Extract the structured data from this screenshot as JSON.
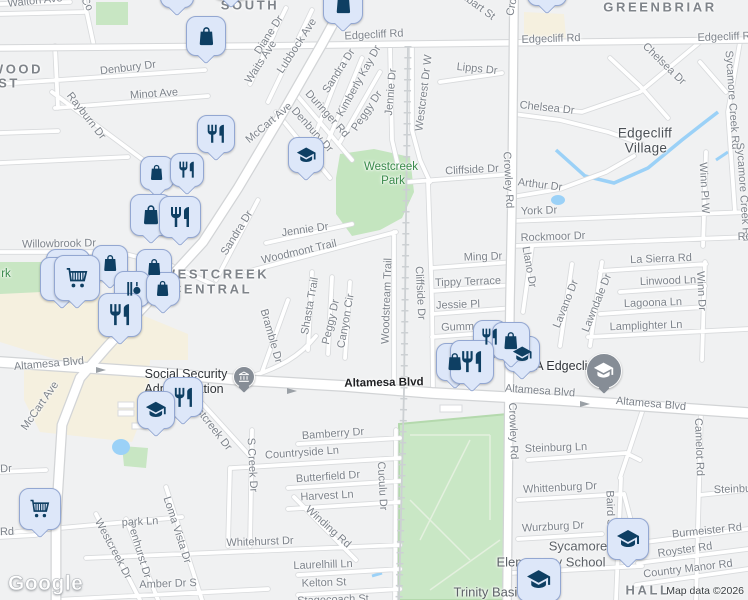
{
  "attribution": {
    "logo": "Google",
    "map_data": "Map data ©2026"
  },
  "colors": {
    "land": "#f0f1f2",
    "road_fill": "#ffffff",
    "road_casing": "#d8dadc",
    "park_green": "#c8e6c3",
    "water_blue": "#9bd1f7",
    "commercial_beige": "#f5f0df",
    "marker_bg": "#dde7f9",
    "marker_border": "#93a7d2",
    "marker_icon": "#0e3f63",
    "poi_circle_gray": "#868d96"
  },
  "labels": [
    {
      "t": "SOUTH",
      "x": 250,
      "y": 5,
      "r": 0,
      "c": "district"
    },
    {
      "t": "GREENBRIAR",
      "x": 660,
      "y": 7,
      "r": 0,
      "c": "district"
    },
    {
      "t": "WOOD",
      "x": 17,
      "y": 69,
      "r": 0,
      "c": "district"
    },
    {
      "t": "ST",
      "x": 9,
      "y": 83,
      "r": 0,
      "c": "district"
    },
    {
      "t": "WESTCREEK",
      "x": 216,
      "y": 274,
      "r": 0,
      "c": "district"
    },
    {
      "t": "CENTRAL",
      "x": 212,
      "y": 289,
      "r": 0,
      "c": "district"
    },
    {
      "t": "HALL",
      "x": 648,
      "y": 590,
      "r": 0,
      "c": "district"
    },
    {
      "t": "Edgecliff",
      "x": 645,
      "y": 133,
      "r": 0,
      "c": "city"
    },
    {
      "t": "Village",
      "x": 646,
      "y": 148,
      "r": 0,
      "c": "city"
    },
    {
      "t": "Westcreek",
      "x": 391,
      "y": 167,
      "r": 0,
      "c": "park"
    },
    {
      "t": "Park",
      "x": 393,
      "y": 181,
      "r": 0,
      "c": "park"
    },
    {
      "t": "rk",
      "x": 6,
      "y": 274,
      "r": 0,
      "c": "park"
    },
    {
      "t": "Social Security",
      "x": 186,
      "y": 374,
      "r": 0,
      "c": "poi"
    },
    {
      "t": "Administration",
      "x": 184,
      "y": 389,
      "r": 0,
      "c": "poi"
    },
    {
      "t": "DEA Edgecliff",
      "x": 556,
      "y": 366,
      "r": 0,
      "c": "poi"
    },
    {
      "t": "Sycamore",
      "x": 578,
      "y": 546,
      "r": 0,
      "c": "school"
    },
    {
      "t": "Elementary School",
      "x": 551,
      "y": 562,
      "r": 0,
      "c": "school"
    },
    {
      "t": "Trinity Basin",
      "x": 489,
      "y": 592,
      "r": 0,
      "c": "school"
    },
    {
      "t": "Altamesa Blvd",
      "x": 384,
      "y": 383,
      "r": -1,
      "c": "road-dark"
    },
    {
      "t": "Walton Ave",
      "x": 35,
      "y": 1,
      "r": -6,
      "c": "road"
    },
    {
      "t": "Co",
      "x": 87,
      "y": 4,
      "r": 62,
      "c": "road"
    },
    {
      "t": "Denbury Dr",
      "x": 128,
      "y": 68,
      "r": -7,
      "c": "road"
    },
    {
      "t": "Minot Ave",
      "x": 154,
      "y": 94,
      "r": -4,
      "c": "road"
    },
    {
      "t": "Rayburn Dr",
      "x": 86,
      "y": 116,
      "r": 52,
      "c": "road"
    },
    {
      "t": "Diane Dr",
      "x": 269,
      "y": 35,
      "r": -57,
      "c": "road"
    },
    {
      "t": "Waits Ave",
      "x": 261,
      "y": 62,
      "r": -57,
      "c": "road"
    },
    {
      "t": "Lubbock Ave",
      "x": 297,
      "y": 46,
      "r": -57,
      "c": "road"
    },
    {
      "t": "Edgecliff Rd",
      "x": 374,
      "y": 35,
      "r": -3,
      "c": "road"
    },
    {
      "t": "Edgecliff Rd",
      "x": 551,
      "y": 39,
      "r": -2,
      "c": "road"
    },
    {
      "t": "Edgecliff Rd",
      "x": 727,
      "y": 37,
      "r": -2,
      "c": "road"
    },
    {
      "t": "Lambart St",
      "x": 472,
      "y": 2,
      "r": 36,
      "c": "road"
    },
    {
      "t": "Chelsea Dr",
      "x": 664,
      "y": 64,
      "r": 44,
      "c": "road"
    },
    {
      "t": "Chelsea Dr",
      "x": 547,
      "y": 108,
      "r": 6,
      "c": "road"
    },
    {
      "t": "Lipps Dr",
      "x": 477,
      "y": 69,
      "r": 6,
      "c": "road"
    },
    {
      "t": "Sandra Dr",
      "x": 339,
      "y": 71,
      "r": -57,
      "c": "road"
    },
    {
      "t": "Kimberly Kay Dr",
      "x": 359,
      "y": 81,
      "r": -61,
      "c": "road"
    },
    {
      "t": "Peggy Dr",
      "x": 367,
      "y": 111,
      "r": -56,
      "c": "road"
    },
    {
      "t": "Jennie Dr",
      "x": 391,
      "y": 92,
      "r": -85,
      "c": "road"
    },
    {
      "t": "Duringer Rd",
      "x": 327,
      "y": 114,
      "r": 48,
      "c": "road"
    },
    {
      "t": "Denbury Dr",
      "x": 312,
      "y": 130,
      "r": 48,
      "c": "road"
    },
    {
      "t": "McCart Ave",
      "x": 269,
      "y": 123,
      "r": -40,
      "c": "road"
    },
    {
      "t": "Westcrest Dr W",
      "x": 424,
      "y": 93,
      "r": -83,
      "c": "road"
    },
    {
      "t": "Sycamore Creek Rd",
      "x": 732,
      "y": 100,
      "r": 86,
      "c": "road"
    },
    {
      "t": "Sycamore Creek Rd",
      "x": 743,
      "y": 192,
      "r": 86,
      "c": "road"
    },
    {
      "t": "Crowley Rd",
      "x": 516,
      "y": -12,
      "r": -78,
      "c": "road"
    },
    {
      "t": "Crowley Rd",
      "x": 508,
      "y": 180,
      "r": 87,
      "c": "road"
    },
    {
      "t": "Crowley Rd",
      "x": 513,
      "y": 431,
      "r": 88,
      "c": "road"
    },
    {
      "t": "Arthur Dr",
      "x": 540,
      "y": 185,
      "r": 7,
      "c": "road"
    },
    {
      "t": "York Dr",
      "x": 539,
      "y": 211,
      "r": -2,
      "c": "road"
    },
    {
      "t": "Rockmoor Dr",
      "x": 553,
      "y": 237,
      "r": -2,
      "c": "road"
    },
    {
      "t": "Rockmoor Dr",
      "x": 770,
      "y": 236,
      "r": -2,
      "c": "road"
    },
    {
      "t": "Llano Dr",
      "x": 529,
      "y": 267,
      "r": 80,
      "c": "road"
    },
    {
      "t": "La Sierra Rd",
      "x": 661,
      "y": 259,
      "r": -2,
      "c": "road"
    },
    {
      "t": "Linwood Ln",
      "x": 668,
      "y": 281,
      "r": -2,
      "c": "road"
    },
    {
      "t": "Lagoona Ln",
      "x": 653,
      "y": 303,
      "r": -2,
      "c": "road"
    },
    {
      "t": "Lamplighter Ln",
      "x": 646,
      "y": 326,
      "r": -2,
      "c": "road"
    },
    {
      "t": "Winn Pl W",
      "x": 704,
      "y": 188,
      "r": 87,
      "c": "road"
    },
    {
      "t": "Winn Dr",
      "x": 701,
      "y": 291,
      "r": 87,
      "c": "road"
    },
    {
      "t": "Lavano Dr",
      "x": 566,
      "y": 304,
      "r": -68,
      "c": "road"
    },
    {
      "t": "Lawndale Dr",
      "x": 597,
      "y": 303,
      "r": -68,
      "c": "road"
    },
    {
      "t": "Ming Dr",
      "x": 483,
      "y": 257,
      "r": -2,
      "c": "road"
    },
    {
      "t": "Tippy Terrace",
      "x": 468,
      "y": 282,
      "r": -2,
      "c": "road"
    },
    {
      "t": "Jessie Pl",
      "x": 458,
      "y": 305,
      "r": -2,
      "c": "road"
    },
    {
      "t": "Gumm Pl",
      "x": 464,
      "y": 327,
      "r": -2,
      "c": "road"
    },
    {
      "t": "Cliffside Dr",
      "x": 472,
      "y": 170,
      "r": -3,
      "c": "road"
    },
    {
      "t": "Cliffside Dr",
      "x": 420,
      "y": 293,
      "r": 87,
      "c": "road"
    },
    {
      "t": "Woodstream Trail",
      "x": 387,
      "y": 301,
      "r": -88,
      "c": "road"
    },
    {
      "t": "Canyon Cir",
      "x": 346,
      "y": 321,
      "r": -80,
      "c": "road"
    },
    {
      "t": "Peggy Dr",
      "x": 331,
      "y": 322,
      "r": -77,
      "c": "road"
    },
    {
      "t": "Shasta Trail",
      "x": 310,
      "y": 306,
      "r": -80,
      "c": "road"
    },
    {
      "t": "Bramble Dr",
      "x": 271,
      "y": 336,
      "r": 74,
      "c": "road"
    },
    {
      "t": "Woodmont Trail",
      "x": 299,
      "y": 252,
      "r": -13,
      "c": "road"
    },
    {
      "t": "Jennie Dr",
      "x": 305,
      "y": 230,
      "r": -8,
      "c": "road"
    },
    {
      "t": "Sandra Dr",
      "x": 237,
      "y": 233,
      "r": -58,
      "c": "road"
    },
    {
      "t": "Willowbrook Dr",
      "x": 59,
      "y": 244,
      "r": -1,
      "c": "road"
    },
    {
      "t": "Altamesa Blvd",
      "x": 49,
      "y": 364,
      "r": -5,
      "c": "road"
    },
    {
      "t": "Altamesa Blvd",
      "x": 540,
      "y": 391,
      "r": 4,
      "c": "road"
    },
    {
      "t": "Altamesa Blvd",
      "x": 651,
      "y": 404,
      "r": 5,
      "c": "road"
    },
    {
      "t": "McCart Ave",
      "x": 40,
      "y": 406,
      "r": -55,
      "c": "road"
    },
    {
      "t": "Westcreek Dr",
      "x": 209,
      "y": 423,
      "r": 52,
      "c": "road"
    },
    {
      "t": "Bamberry Dr",
      "x": 333,
      "y": 434,
      "r": -4,
      "c": "road"
    },
    {
      "t": "Countryside Ln",
      "x": 302,
      "y": 453,
      "r": -4,
      "c": "road"
    },
    {
      "t": "Butterfield Dr",
      "x": 328,
      "y": 477,
      "r": -4,
      "c": "road"
    },
    {
      "t": "Harvest Ln",
      "x": 327,
      "y": 496,
      "r": -3,
      "c": "road"
    },
    {
      "t": "Winding Rd",
      "x": 328,
      "y": 527,
      "r": 42,
      "c": "road"
    },
    {
      "t": "Whitehurst Dr",
      "x": 260,
      "y": 542,
      "r": -2,
      "c": "road"
    },
    {
      "t": "Laurelhill Ln",
      "x": 323,
      "y": 565,
      "r": -2,
      "c": "road"
    },
    {
      "t": "Kelton St",
      "x": 324,
      "y": 583,
      "r": -2,
      "c": "road"
    },
    {
      "t": "Stagecoach St",
      "x": 333,
      "y": 600,
      "r": -2,
      "c": "road"
    },
    {
      "t": "S Creek Dr",
      "x": 252,
      "y": 465,
      "r": 87,
      "c": "road"
    },
    {
      "t": "Cuculu Dr",
      "x": 382,
      "y": 486,
      "r": 87,
      "c": "road"
    },
    {
      "t": "Loma Vista Dr",
      "x": 177,
      "y": 530,
      "r": 72,
      "c": "road"
    },
    {
      "t": "Penhurst Dr",
      "x": 139,
      "y": 550,
      "r": 73,
      "c": "road"
    },
    {
      "t": "Westcreek Dr",
      "x": 113,
      "y": 549,
      "r": 62,
      "c": "road"
    },
    {
      "t": "park Ln",
      "x": 140,
      "y": 522,
      "r": -3,
      "c": "road"
    },
    {
      "t": "Rd",
      "x": 7,
      "y": 532,
      "r": -2,
      "c": "road"
    },
    {
      "t": "Dr",
      "x": 6,
      "y": 469,
      "r": -2,
      "c": "road"
    },
    {
      "t": "Amber Dr S",
      "x": 168,
      "y": 584,
      "r": -2,
      "c": "road"
    },
    {
      "t": "Steinburg Ln",
      "x": 556,
      "y": 448,
      "r": -2,
      "c": "road"
    },
    {
      "t": "Whittenburg Dr",
      "x": 560,
      "y": 488,
      "r": -3,
      "c": "road"
    },
    {
      "t": "Wurzburg Dr",
      "x": 553,
      "y": 527,
      "r": -3,
      "c": "road"
    },
    {
      "t": "Baird St",
      "x": 610,
      "y": 510,
      "r": 88,
      "c": "road"
    },
    {
      "t": "Camelot Rd",
      "x": 699,
      "y": 447,
      "r": 88,
      "c": "road"
    },
    {
      "t": "Steinburg Ln",
      "x": 745,
      "y": 489,
      "r": -2,
      "c": "road"
    },
    {
      "t": "Burmeister Rd",
      "x": 707,
      "y": 531,
      "r": -6,
      "c": "road"
    },
    {
      "t": "Royster Rd",
      "x": 685,
      "y": 550,
      "r": -8,
      "c": "road"
    },
    {
      "t": "Country Manor Rd",
      "x": 688,
      "y": 569,
      "r": -7,
      "c": "road"
    }
  ],
  "markers": [
    {
      "k": "shopping-bag",
      "x": 160,
      "y": -26,
      "s": 34,
      "blank": true
    },
    {
      "k": "shopping-bag",
      "x": 212,
      "y": -38,
      "s": 38,
      "blank": true
    },
    {
      "k": "shopping-bag",
      "x": 186,
      "y": 16,
      "s": 40
    },
    {
      "k": "shopping-bag",
      "x": 323,
      "y": -16,
      "s": 40
    },
    {
      "k": "shopping-bag",
      "x": 527,
      "y": -34,
      "s": 40,
      "blank": true
    },
    {
      "k": "restaurant",
      "x": 197,
      "y": 115,
      "s": 38
    },
    {
      "k": "school",
      "x": 288,
      "y": 137,
      "s": 36
    },
    {
      "k": "shopping-bag",
      "x": 140,
      "y": 156,
      "s": 34
    },
    {
      "k": "restaurant",
      "x": 170,
      "y": 153,
      "s": 34
    },
    {
      "k": "shopping-bag",
      "x": 130,
      "y": 194,
      "s": 42
    },
    {
      "k": "restaurant",
      "x": 159,
      "y": 196,
      "s": 42
    },
    {
      "k": "shopping-bag",
      "x": 92,
      "y": 245,
      "s": 36
    },
    {
      "k": "shopping-bag",
      "x": 136,
      "y": 249,
      "s": 36
    },
    {
      "k": "grocery-cart",
      "x": 46,
      "y": 249,
      "s": 44,
      "blank": true
    },
    {
      "k": "grocery-cart",
      "x": 40,
      "y": 257,
      "s": 44,
      "blank": true
    },
    {
      "k": "bottles",
      "x": 114,
      "y": 271,
      "s": 36
    },
    {
      "k": "shopping-bag",
      "x": 146,
      "y": 272,
      "s": 34
    },
    {
      "k": "grocery-cart",
      "x": 54,
      "y": 255,
      "s": 46
    },
    {
      "k": "restaurant",
      "x": 98,
      "y": 293,
      "s": 44
    },
    {
      "k": "restaurant",
      "x": 163,
      "y": 377,
      "s": 40
    },
    {
      "k": "school",
      "x": 137,
      "y": 391,
      "s": 38
    },
    {
      "k": "restaurant",
      "x": 473,
      "y": 320,
      "s": 34
    },
    {
      "k": "school",
      "x": 504,
      "y": 336,
      "s": 36
    },
    {
      "k": "shopping-bag",
      "x": 492,
      "y": 322,
      "s": 38
    },
    {
      "k": "shopping-bag",
      "x": 436,
      "y": 343,
      "s": 38
    },
    {
      "k": "restaurant",
      "x": 450,
      "y": 340,
      "s": 44
    },
    {
      "k": "grocery-cart",
      "x": 19,
      "y": 488,
      "s": 42
    },
    {
      "k": "school",
      "x": 607,
      "y": 518,
      "s": 42
    },
    {
      "k": "school",
      "x": 517,
      "y": 558,
      "s": 44
    }
  ],
  "poi_pins": [
    {
      "k": "civic-building",
      "x": 233,
      "y": 366,
      "s": 22
    },
    {
      "k": "school",
      "x": 586,
      "y": 353,
      "s": 36
    }
  ]
}
